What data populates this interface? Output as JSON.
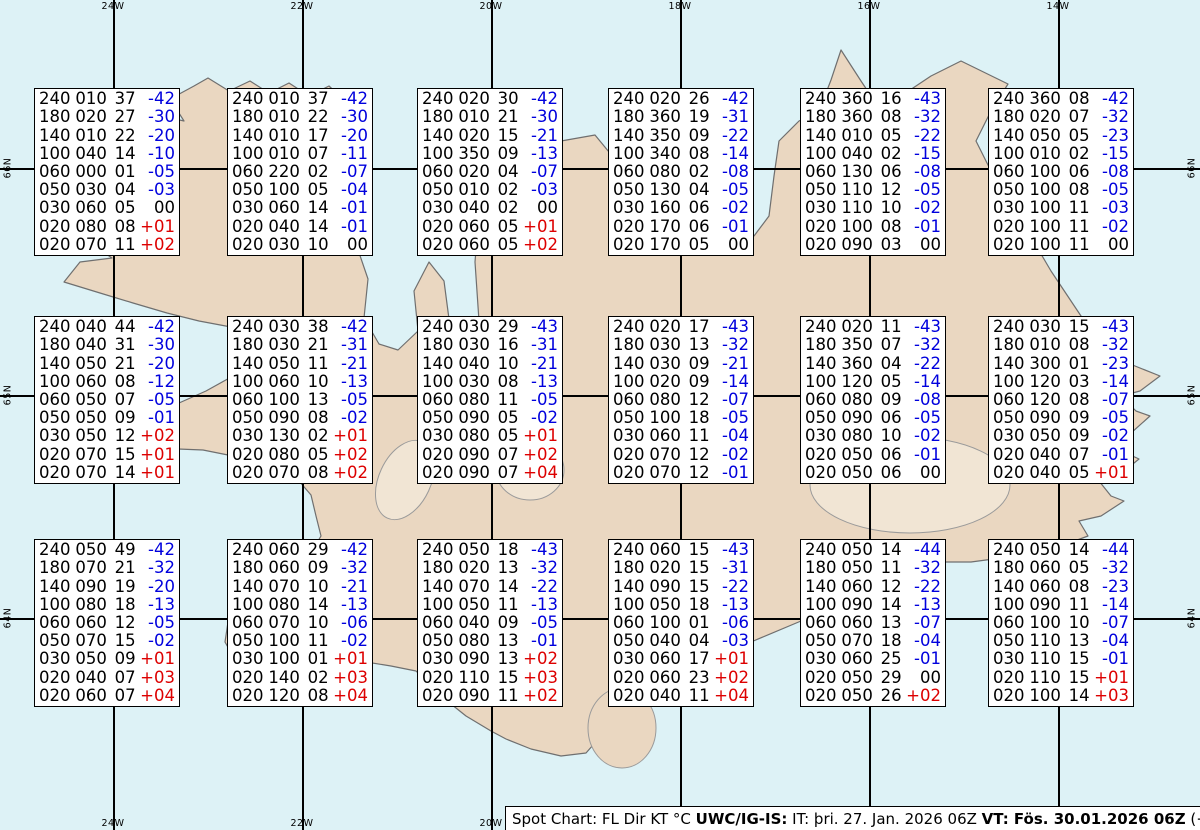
{
  "grid": {
    "top_labels": [
      "24W",
      "22W",
      "20W",
      "18W",
      "16W",
      "14W"
    ],
    "bottom_labels": [
      "24W",
      "22W",
      "20W"
    ],
    "left_labels": [
      "66N",
      "65N",
      "64N"
    ],
    "right_labels": [
      "66N",
      "65N",
      "64N"
    ],
    "lon_x": [
      113,
      302,
      491,
      680,
      869,
      1058
    ],
    "lat_y": [
      168,
      395,
      618
    ]
  },
  "colors": {
    "ocean": "#ddf2f6",
    "land": "#ead7c1",
    "coast": "#6f6f6f",
    "grid_line": "#000000",
    "temp_negative": "#0000dd",
    "temp_positive": "#dd0000",
    "text": "#000000"
  },
  "layout": {
    "columns_x": [
      34,
      227,
      417,
      608,
      800,
      988
    ],
    "rows_y": [
      88,
      316,
      539
    ]
  },
  "boxes": [
    {
      "rows": [
        [
          "240",
          "010",
          "37",
          "-42"
        ],
        [
          "180",
          "020",
          "27",
          "-30"
        ],
        [
          "140",
          "010",
          "22",
          "-20"
        ],
        [
          "100",
          "040",
          "14",
          "-10"
        ],
        [
          "060",
          "000",
          "01",
          "-05"
        ],
        [
          "050",
          "030",
          "04",
          "-03"
        ],
        [
          "030",
          "060",
          "05",
          "00"
        ],
        [
          "020",
          "080",
          "08",
          "+01"
        ],
        [
          "020",
          "070",
          "11",
          "+02"
        ]
      ]
    },
    {
      "rows": [
        [
          "240",
          "010",
          "37",
          "-42"
        ],
        [
          "180",
          "010",
          "22",
          "-30"
        ],
        [
          "140",
          "010",
          "17",
          "-20"
        ],
        [
          "100",
          "010",
          "07",
          "-11"
        ],
        [
          "060",
          "220",
          "02",
          "-07"
        ],
        [
          "050",
          "100",
          "05",
          "-04"
        ],
        [
          "030",
          "060",
          "14",
          "-01"
        ],
        [
          "020",
          "040",
          "14",
          "-01"
        ],
        [
          "020",
          "030",
          "10",
          "00"
        ]
      ]
    },
    {
      "rows": [
        [
          "240",
          "020",
          "30",
          "-42"
        ],
        [
          "180",
          "010",
          "21",
          "-30"
        ],
        [
          "140",
          "020",
          "15",
          "-21"
        ],
        [
          "100",
          "350",
          "09",
          "-13"
        ],
        [
          "060",
          "020",
          "04",
          "-07"
        ],
        [
          "050",
          "010",
          "02",
          "-03"
        ],
        [
          "030",
          "040",
          "02",
          "00"
        ],
        [
          "020",
          "060",
          "05",
          "+01"
        ],
        [
          "020",
          "060",
          "05",
          "+02"
        ]
      ]
    },
    {
      "rows": [
        [
          "240",
          "020",
          "26",
          "-42"
        ],
        [
          "180",
          "360",
          "19",
          "-31"
        ],
        [
          "140",
          "350",
          "09",
          "-22"
        ],
        [
          "100",
          "340",
          "08",
          "-14"
        ],
        [
          "060",
          "080",
          "02",
          "-08"
        ],
        [
          "050",
          "130",
          "04",
          "-05"
        ],
        [
          "030",
          "160",
          "06",
          "-02"
        ],
        [
          "020",
          "170",
          "06",
          "-01"
        ],
        [
          "020",
          "170",
          "05",
          "00"
        ]
      ]
    },
    {
      "rows": [
        [
          "240",
          "360",
          "16",
          "-43"
        ],
        [
          "180",
          "360",
          "08",
          "-32"
        ],
        [
          "140",
          "010",
          "05",
          "-22"
        ],
        [
          "100",
          "040",
          "02",
          "-15"
        ],
        [
          "060",
          "130",
          "06",
          "-08"
        ],
        [
          "050",
          "110",
          "12",
          "-05"
        ],
        [
          "030",
          "110",
          "10",
          "-02"
        ],
        [
          "020",
          "100",
          "08",
          "-01"
        ],
        [
          "020",
          "090",
          "03",
          "00"
        ]
      ]
    },
    {
      "rows": [
        [
          "240",
          "360",
          "08",
          "-42"
        ],
        [
          "180",
          "020",
          "07",
          "-32"
        ],
        [
          "140",
          "050",
          "05",
          "-23"
        ],
        [
          "100",
          "010",
          "02",
          "-15"
        ],
        [
          "060",
          "100",
          "06",
          "-08"
        ],
        [
          "050",
          "100",
          "08",
          "-05"
        ],
        [
          "030",
          "100",
          "11",
          "-03"
        ],
        [
          "020",
          "100",
          "11",
          "-02"
        ],
        [
          "020",
          "100",
          "11",
          "00"
        ]
      ]
    },
    {
      "rows": [
        [
          "240",
          "040",
          "44",
          "-42"
        ],
        [
          "180",
          "040",
          "31",
          "-30"
        ],
        [
          "140",
          "050",
          "21",
          "-20"
        ],
        [
          "100",
          "060",
          "08",
          "-12"
        ],
        [
          "060",
          "050",
          "07",
          "-05"
        ],
        [
          "050",
          "050",
          "09",
          "-01"
        ],
        [
          "030",
          "050",
          "12",
          "+02"
        ],
        [
          "020",
          "070",
          "15",
          "+01"
        ],
        [
          "020",
          "070",
          "14",
          "+01"
        ]
      ]
    },
    {
      "rows": [
        [
          "240",
          "030",
          "38",
          "-42"
        ],
        [
          "180",
          "030",
          "21",
          "-31"
        ],
        [
          "140",
          "050",
          "11",
          "-21"
        ],
        [
          "100",
          "060",
          "10",
          "-13"
        ],
        [
          "060",
          "100",
          "13",
          "-05"
        ],
        [
          "050",
          "090",
          "08",
          "-02"
        ],
        [
          "030",
          "130",
          "02",
          "+01"
        ],
        [
          "020",
          "080",
          "05",
          "+02"
        ],
        [
          "020",
          "070",
          "08",
          "+02"
        ]
      ]
    },
    {
      "rows": [
        [
          "240",
          "030",
          "29",
          "-43"
        ],
        [
          "180",
          "030",
          "16",
          "-31"
        ],
        [
          "140",
          "040",
          "10",
          "-21"
        ],
        [
          "100",
          "030",
          "08",
          "-13"
        ],
        [
          "060",
          "080",
          "11",
          "-05"
        ],
        [
          "050",
          "090",
          "05",
          "-02"
        ],
        [
          "030",
          "080",
          "05",
          "+01"
        ],
        [
          "020",
          "090",
          "07",
          "+02"
        ],
        [
          "020",
          "090",
          "07",
          "+04"
        ]
      ]
    },
    {
      "rows": [
        [
          "240",
          "020",
          "17",
          "-43"
        ],
        [
          "180",
          "030",
          "13",
          "-32"
        ],
        [
          "140",
          "030",
          "09",
          "-21"
        ],
        [
          "100",
          "020",
          "09",
          "-14"
        ],
        [
          "060",
          "080",
          "12",
          "-07"
        ],
        [
          "050",
          "100",
          "18",
          "-05"
        ],
        [
          "030",
          "060",
          "11",
          "-04"
        ],
        [
          "020",
          "070",
          "12",
          "-02"
        ],
        [
          "020",
          "070",
          "12",
          "-01"
        ]
      ]
    },
    {
      "rows": [
        [
          "240",
          "020",
          "11",
          "-43"
        ],
        [
          "180",
          "350",
          "07",
          "-32"
        ],
        [
          "140",
          "360",
          "04",
          "-22"
        ],
        [
          "100",
          "120",
          "05",
          "-14"
        ],
        [
          "060",
          "080",
          "09",
          "-08"
        ],
        [
          "050",
          "090",
          "06",
          "-05"
        ],
        [
          "030",
          "080",
          "10",
          "-02"
        ],
        [
          "020",
          "050",
          "06",
          "-01"
        ],
        [
          "020",
          "050",
          "06",
          "00"
        ]
      ]
    },
    {
      "rows": [
        [
          "240",
          "030",
          "15",
          "-43"
        ],
        [
          "180",
          "010",
          "08",
          "-32"
        ],
        [
          "140",
          "300",
          "01",
          "-23"
        ],
        [
          "100",
          "120",
          "03",
          "-14"
        ],
        [
          "060",
          "120",
          "08",
          "-07"
        ],
        [
          "050",
          "090",
          "09",
          "-05"
        ],
        [
          "030",
          "050",
          "09",
          "-02"
        ],
        [
          "020",
          "040",
          "07",
          "-01"
        ],
        [
          "020",
          "040",
          "05",
          "+01"
        ]
      ]
    },
    {
      "rows": [
        [
          "240",
          "050",
          "49",
          "-42"
        ],
        [
          "180",
          "070",
          "21",
          "-32"
        ],
        [
          "140",
          "090",
          "19",
          "-20"
        ],
        [
          "100",
          "080",
          "18",
          "-13"
        ],
        [
          "060",
          "060",
          "12",
          "-05"
        ],
        [
          "050",
          "070",
          "15",
          "-02"
        ],
        [
          "030",
          "050",
          "09",
          "+01"
        ],
        [
          "020",
          "040",
          "07",
          "+03"
        ],
        [
          "020",
          "060",
          "07",
          "+04"
        ]
      ]
    },
    {
      "rows": [
        [
          "240",
          "060",
          "29",
          "-42"
        ],
        [
          "180",
          "060",
          "09",
          "-32"
        ],
        [
          "140",
          "070",
          "10",
          "-21"
        ],
        [
          "100",
          "080",
          "14",
          "-13"
        ],
        [
          "060",
          "070",
          "10",
          "-06"
        ],
        [
          "050",
          "100",
          "11",
          "-02"
        ],
        [
          "030",
          "100",
          "01",
          "+01"
        ],
        [
          "020",
          "140",
          "02",
          "+03"
        ],
        [
          "020",
          "120",
          "08",
          "+04"
        ]
      ]
    },
    {
      "rows": [
        [
          "240",
          "050",
          "18",
          "-43"
        ],
        [
          "180",
          "020",
          "13",
          "-32"
        ],
        [
          "140",
          "070",
          "14",
          "-22"
        ],
        [
          "100",
          "050",
          "11",
          "-13"
        ],
        [
          "060",
          "040",
          "09",
          "-05"
        ],
        [
          "050",
          "080",
          "13",
          "-01"
        ],
        [
          "030",
          "090",
          "13",
          "+02"
        ],
        [
          "020",
          "110",
          "15",
          "+03"
        ],
        [
          "020",
          "090",
          "11",
          "+02"
        ]
      ]
    },
    {
      "rows": [
        [
          "240",
          "060",
          "15",
          "-43"
        ],
        [
          "180",
          "020",
          "15",
          "-31"
        ],
        [
          "140",
          "090",
          "15",
          "-22"
        ],
        [
          "100",
          "050",
          "18",
          "-13"
        ],
        [
          "060",
          "100",
          "01",
          "-06"
        ],
        [
          "050",
          "040",
          "04",
          "-03"
        ],
        [
          "030",
          "060",
          "17",
          "+01"
        ],
        [
          "020",
          "060",
          "23",
          "+02"
        ],
        [
          "020",
          "040",
          "11",
          "+04"
        ]
      ]
    },
    {
      "rows": [
        [
          "240",
          "050",
          "14",
          "-44"
        ],
        [
          "180",
          "050",
          "11",
          "-32"
        ],
        [
          "140",
          "060",
          "12",
          "-22"
        ],
        [
          "100",
          "090",
          "14",
          "-13"
        ],
        [
          "060",
          "060",
          "13",
          "-07"
        ],
        [
          "050",
          "070",
          "18",
          "-04"
        ],
        [
          "030",
          "060",
          "25",
          "-01"
        ],
        [
          "020",
          "050",
          "29",
          "00"
        ],
        [
          "020",
          "050",
          "26",
          "+02"
        ]
      ]
    },
    {
      "rows": [
        [
          "240",
          "050",
          "14",
          "-44"
        ],
        [
          "180",
          "060",
          "05",
          "-32"
        ],
        [
          "140",
          "060",
          "08",
          "-23"
        ],
        [
          "100",
          "090",
          "11",
          "-14"
        ],
        [
          "060",
          "100",
          "10",
          "-07"
        ],
        [
          "050",
          "110",
          "13",
          "-04"
        ],
        [
          "030",
          "110",
          "15",
          "-01"
        ],
        [
          "020",
          "110",
          "15",
          "+01"
        ],
        [
          "020",
          "100",
          "14",
          "+03"
        ]
      ]
    }
  ],
  "footer": {
    "segments": [
      {
        "text": "Spot Chart: FL Dir KT °C ",
        "bold": false
      },
      {
        "text": "UWC/IG-IS:",
        "bold": true
      },
      {
        "text": " IT: þri. 27. Jan. 2026 06Z ",
        "bold": false
      },
      {
        "text": "VT: Fös. 30.01.2026 06Z",
        "bold": true
      },
      {
        "text": " (+72 h)",
        "bold": false
      }
    ]
  }
}
